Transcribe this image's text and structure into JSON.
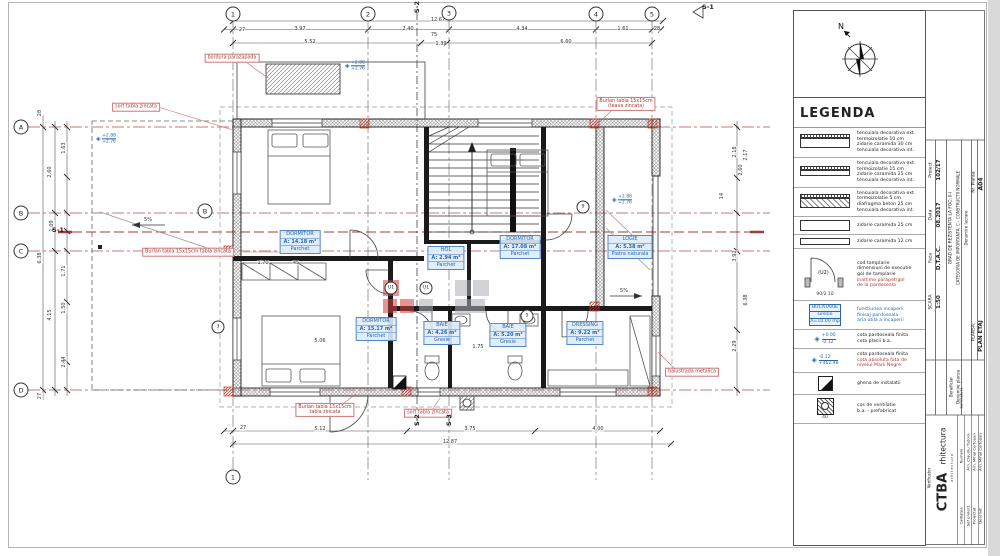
{
  "colors": {
    "accent_red": "#b03636",
    "accent_blue": "#2a66a8",
    "watermark_red": "#d24040",
    "watermark_gray": "#aaafb5"
  },
  "legend": {
    "title": "LEGENDA",
    "north_label": "N",
    "walls": [
      {
        "l1": "tencuiala decorativa ext.",
        "l2": "termoizolatie 10 cm",
        "l3": "zidarie caramida 30 cm",
        "l4": "tencuiala decorativa int."
      },
      {
        "l1": "tencuiala decorativa ext.",
        "l2": "termoizolatie 15 cm",
        "l3": "zidarie caramida 25 cm",
        "l4": "tencuiala decorativa int."
      },
      {
        "l1": "tencuiala decorativa ext.",
        "l2": "termoizolatie 5 cm",
        "l3": "diafragma beton 25 cm",
        "l4": "tencuiala decorativa int."
      },
      {
        "l1": "zidarie caramida 25 cm"
      },
      {
        "l1": "zidarie caramida 12 cm"
      }
    ],
    "door": {
      "tag": "(U2)",
      "dim_w": "90",
      "dim_h": "2.10",
      "t1": "cod tamplarie",
      "t2": "dimensiuni de executie",
      "t3": "gol de tamplarie",
      "t4": "inaltime parapet/gol",
      "t5": "de la pardoseala"
    },
    "room_sample": {
      "name": "BUCATARIE",
      "finish": "Gresie",
      "area": "A=10.00 mp",
      "t1": "functiunea incaperii",
      "t2": "finisaj pardoseala",
      "t3": "aria utila a incaperii"
    },
    "level1": {
      "a": "+0.00",
      "b": "-0.12",
      "t1": "cota pardoseala finita",
      "t2": "cota placii b.a."
    },
    "level2": {
      "a": "-0.12",
      "b": "+462.48",
      "t1": "cota pardoseala finita",
      "t2": "cota absoluta fata de",
      "t3": "nivelul Marii Negre"
    },
    "ghena": {
      "t1": "ghena de instalatii"
    },
    "vent": {
      "dim": "40",
      "t1": "cos de ventilatie",
      "t2": "b.a. - prefabricat"
    }
  },
  "render": {
    "dims": [
      {
        "x": 242,
        "y": 30,
        "t": "27"
      },
      {
        "x": 300,
        "y": 29,
        "t": "3.97"
      },
      {
        "x": 408,
        "y": 29,
        "t": "2.40"
      },
      {
        "x": 522,
        "y": 29,
        "t": "4.34"
      },
      {
        "x": 623,
        "y": 29,
        "t": "1.61"
      },
      {
        "x": 657,
        "y": 29,
        "t": "28"
      },
      {
        "x": 438,
        "y": 20,
        "t": "12.67"
      },
      {
        "x": 310,
        "y": 42,
        "t": "5.52"
      },
      {
        "x": 434,
        "y": 35,
        "t": "75"
      },
      {
        "x": 441,
        "y": 44,
        "t": "1.39"
      },
      {
        "x": 566,
        "y": 42,
        "t": "6.60"
      },
      {
        "x": 243,
        "y": 428,
        "t": "27"
      },
      {
        "x": 320,
        "y": 429,
        "t": "5.12"
      },
      {
        "x": 470,
        "y": 429,
        "t": "3.75"
      },
      {
        "x": 598,
        "y": 429,
        "t": "4.00"
      },
      {
        "x": 450,
        "y": 442,
        "t": "12.87"
      },
      {
        "x": 40,
        "y": 113,
        "t": "28",
        "r": -90
      },
      {
        "x": 64,
        "y": 148,
        "t": "1.63",
        "r": -90
      },
      {
        "x": 50,
        "y": 172,
        "t": "2.60",
        "r": -90
      },
      {
        "x": 52,
        "y": 226,
        "t": "1.09",
        "r": -90
      },
      {
        "x": 40,
        "y": 258,
        "t": "6.38",
        "r": -90
      },
      {
        "x": 64,
        "y": 271,
        "t": "1.71",
        "r": -90
      },
      {
        "x": 64,
        "y": 308,
        "t": "1.50",
        "r": -90
      },
      {
        "x": 50,
        "y": 315,
        "t": "4.15",
        "r": -90
      },
      {
        "x": 64,
        "y": 362,
        "t": "2.44",
        "r": -90
      },
      {
        "x": 40,
        "y": 396,
        "t": "27",
        "r": -90
      },
      {
        "x": 735,
        "y": 152,
        "t": "2.18",
        "r": -90
      },
      {
        "x": 746,
        "y": 155,
        "t": "2.17",
        "r": -90
      },
      {
        "x": 741,
        "y": 170,
        "t": "2.60",
        "r": -90
      },
      {
        "x": 722,
        "y": 196,
        "t": "14",
        "r": -90
      },
      {
        "x": 735,
        "y": 256,
        "t": "3.92",
        "r": -90
      },
      {
        "x": 746,
        "y": 300,
        "t": "6.38",
        "r": -90
      },
      {
        "x": 735,
        "y": 346,
        "t": "2.29",
        "r": -90
      },
      {
        "x": 263,
        "y": 263,
        "t": "1.70"
      },
      {
        "x": 296,
        "y": 263,
        "t": "45"
      },
      {
        "x": 320,
        "y": 341,
        "t": "5.06"
      },
      {
        "x": 478,
        "y": 347,
        "t": "1.75"
      },
      {
        "x": 148,
        "y": 220,
        "t": "5%"
      },
      {
        "x": 624,
        "y": 291,
        "t": "5%"
      }
    ],
    "bubbles": [
      {
        "x": 233,
        "y": 14,
        "t": "1"
      },
      {
        "x": 368,
        "y": 14,
        "t": "2"
      },
      {
        "x": 449,
        "y": 13,
        "t": "3"
      },
      {
        "x": 596,
        "y": 14,
        "t": "4"
      },
      {
        "x": 652,
        "y": 14,
        "t": "5"
      },
      {
        "x": 233,
        "y": 477,
        "t": "1"
      },
      {
        "x": 21,
        "y": 127,
        "t": "A"
      },
      {
        "x": 21,
        "y": 213,
        "t": "B"
      },
      {
        "x": 21,
        "y": 251,
        "t": "C"
      },
      {
        "x": 21,
        "y": 390,
        "t": "D"
      },
      {
        "x": 205,
        "y": 211,
        "t": "B"
      }
    ],
    "tags": [
      {
        "x": 391,
        "y": 288,
        "t": "U1"
      },
      {
        "x": 426,
        "y": 288,
        "t": "U1"
      },
      {
        "x": 527,
        "y": 316,
        "t": "5"
      },
      {
        "x": 583,
        "y": 207,
        "t": "9"
      },
      {
        "x": 218,
        "y": 327,
        "t": "3"
      }
    ],
    "rooms": [
      {
        "x": 300,
        "y": 230,
        "name": "DORMITOR",
        "area": "A: 14.18 m²",
        "finish": "Parchet"
      },
      {
        "x": 520,
        "y": 235,
        "name": "DORMITOR",
        "area": "A: 17.08 m²",
        "finish": "Parchet"
      },
      {
        "x": 630,
        "y": 235,
        "name": "LOGIE",
        "area": "A: 5.38 m²",
        "finish": "Piatra naturala"
      },
      {
        "x": 446,
        "y": 246,
        "name": "HOL",
        "area": "A: 2.94 m²",
        "finish": "Parchet"
      },
      {
        "x": 376,
        "y": 317,
        "name": "DORMITOR",
        "area": "A: 15.17 m²",
        "finish": "Parchet"
      },
      {
        "x": 442,
        "y": 321,
        "name": "BAIE",
        "area": "A: 4.26 m²",
        "finish": "Gresie"
      },
      {
        "x": 508,
        "y": 323,
        "name": "BAIE",
        "area": "A: 5.20 m²",
        "finish": "Gresie"
      },
      {
        "x": 585,
        "y": 321,
        "name": "DRESSING",
        "area": "A: 9.22 m²",
        "finish": "Parchet"
      }
    ],
    "callouts": [
      {
        "x": 232,
        "y": 58,
        "l1": "bordura parazapada"
      },
      {
        "x": 136,
        "y": 107,
        "l1": "sort tabla zincata"
      },
      {
        "x": 626,
        "y": 104,
        "l1": "Burlan tabla 15x15cm",
        "l2": "(teava zincata)"
      },
      {
        "x": 188,
        "y": 252,
        "l1": "Burlan tabla 15x15cm tabla zincata"
      },
      {
        "x": 325,
        "y": 410,
        "l1": "Burlan tabla 15x15cm",
        "l2": "tabla zincata"
      },
      {
        "x": 428,
        "y": 413,
        "l1": "sort tabla zincata"
      },
      {
        "x": 692,
        "y": 372,
        "l1": "balustrada metalica"
      }
    ],
    "levels": [
      {
        "x": 345,
        "y": 66,
        "a": "+2.88",
        "b": "+2.76"
      },
      {
        "x": 96,
        "y": 139,
        "a": "+2.88",
        "b": "+2.76"
      },
      {
        "x": 612,
        "y": 200,
        "a": "+2.88",
        "b": "+2.76"
      }
    ],
    "sections": [
      {
        "x": 417,
        "y": 7,
        "t": "S-2",
        "r": -90
      },
      {
        "x": 417,
        "y": 420,
        "t": "S-2",
        "r": -90
      },
      {
        "x": 449,
        "y": 420,
        "t": "S-3",
        "r": -90
      },
      {
        "x": 58,
        "y": 230,
        "t": "S-1"
      },
      {
        "x": 708,
        "y": 7,
        "t": "S-1"
      }
    ],
    "tb": [
      {
        "x": 931,
        "y": 170,
        "t": "Proiect",
        "s": 4.5
      },
      {
        "x": 939,
        "y": 170,
        "t": "102/17",
        "s": 5.5,
        "b": 1
      },
      {
        "x": 931,
        "y": 215,
        "t": "Data",
        "s": 4.5
      },
      {
        "x": 939,
        "y": 215,
        "t": "08.2017",
        "s": 5.5,
        "b": 1
      },
      {
        "x": 931,
        "y": 258,
        "t": "Faza",
        "s": 4.5
      },
      {
        "x": 939,
        "y": 258,
        "t": "D.T.A.C.",
        "s": 5.5,
        "b": 1
      },
      {
        "x": 931,
        "y": 302,
        "t": "SCARA",
        "s": 4.5
      },
      {
        "x": 939,
        "y": 302,
        "t": "1:50",
        "s": 5.5,
        "b": 1
      },
      {
        "x": 951,
        "y": 228,
        "t": "GRAD DE REZISTENTA LA FOC: II-I",
        "s": 4.3
      },
      {
        "x": 958,
        "y": 228,
        "t": "CATEGORIA DE IMPORTANTA: C - CONSTRUCTII NORMALE",
        "s": 4
      },
      {
        "x": 966,
        "y": 228,
        "t": "Denumire lucrare",
        "s": 4
      },
      {
        "x": 951,
        "y": 387,
        "t": "Beneficiar",
        "s": 4
      },
      {
        "x": 958,
        "y": 387,
        "t": "Denumire plansa",
        "s": 4
      },
      {
        "x": 974,
        "y": 182,
        "t": "Nr. Plansa",
        "s": 4.3
      },
      {
        "x": 981,
        "y": 184,
        "t": "A04",
        "s": 6,
        "b": 1
      },
      {
        "x": 974,
        "y": 332,
        "t": "PLANSA:",
        "s": 4.3
      },
      {
        "x": 981,
        "y": 336,
        "t": "PLAN ETAJ",
        "s": 5.5,
        "b": 1
      },
      {
        "x": 929,
        "y": 478,
        "t": "Verificator",
        "s": 4
      },
      {
        "x": 943,
        "y": 492,
        "t": "CTBA",
        "s": 13,
        "b": 1
      },
      {
        "x": 943,
        "y": 446,
        "t": "rhitectura",
        "s": 7.5
      },
      {
        "x": 952,
        "y": 468,
        "t": "a r h i t e c t u r a",
        "s": 3.2
      },
      {
        "x": 961,
        "y": 516,
        "t": "Calitatea",
        "s": 3.8
      },
      {
        "x": 961,
        "y": 456,
        "t": "Numele",
        "s": 3.8
      },
      {
        "x": 961,
        "y": 398,
        "t": "Semnatura",
        "s": 3.8
      },
      {
        "x": 968,
        "y": 516,
        "t": "Sef proiect",
        "s": 3.8
      },
      {
        "x": 968,
        "y": 452,
        "t": "Arh. Claudiu Tudora",
        "s": 3.8
      },
      {
        "x": 974,
        "y": 516,
        "t": "Proiectat",
        "s": 3.8
      },
      {
        "x": 974,
        "y": 452,
        "t": "Arh. Mihai Cortopan",
        "s": 3.8
      },
      {
        "x": 980,
        "y": 516,
        "t": "Desenat",
        "s": 3.8
      },
      {
        "x": 980,
        "y": 452,
        "t": "Arh. Mihai Cortopan",
        "s": 3.8
      }
    ]
  }
}
